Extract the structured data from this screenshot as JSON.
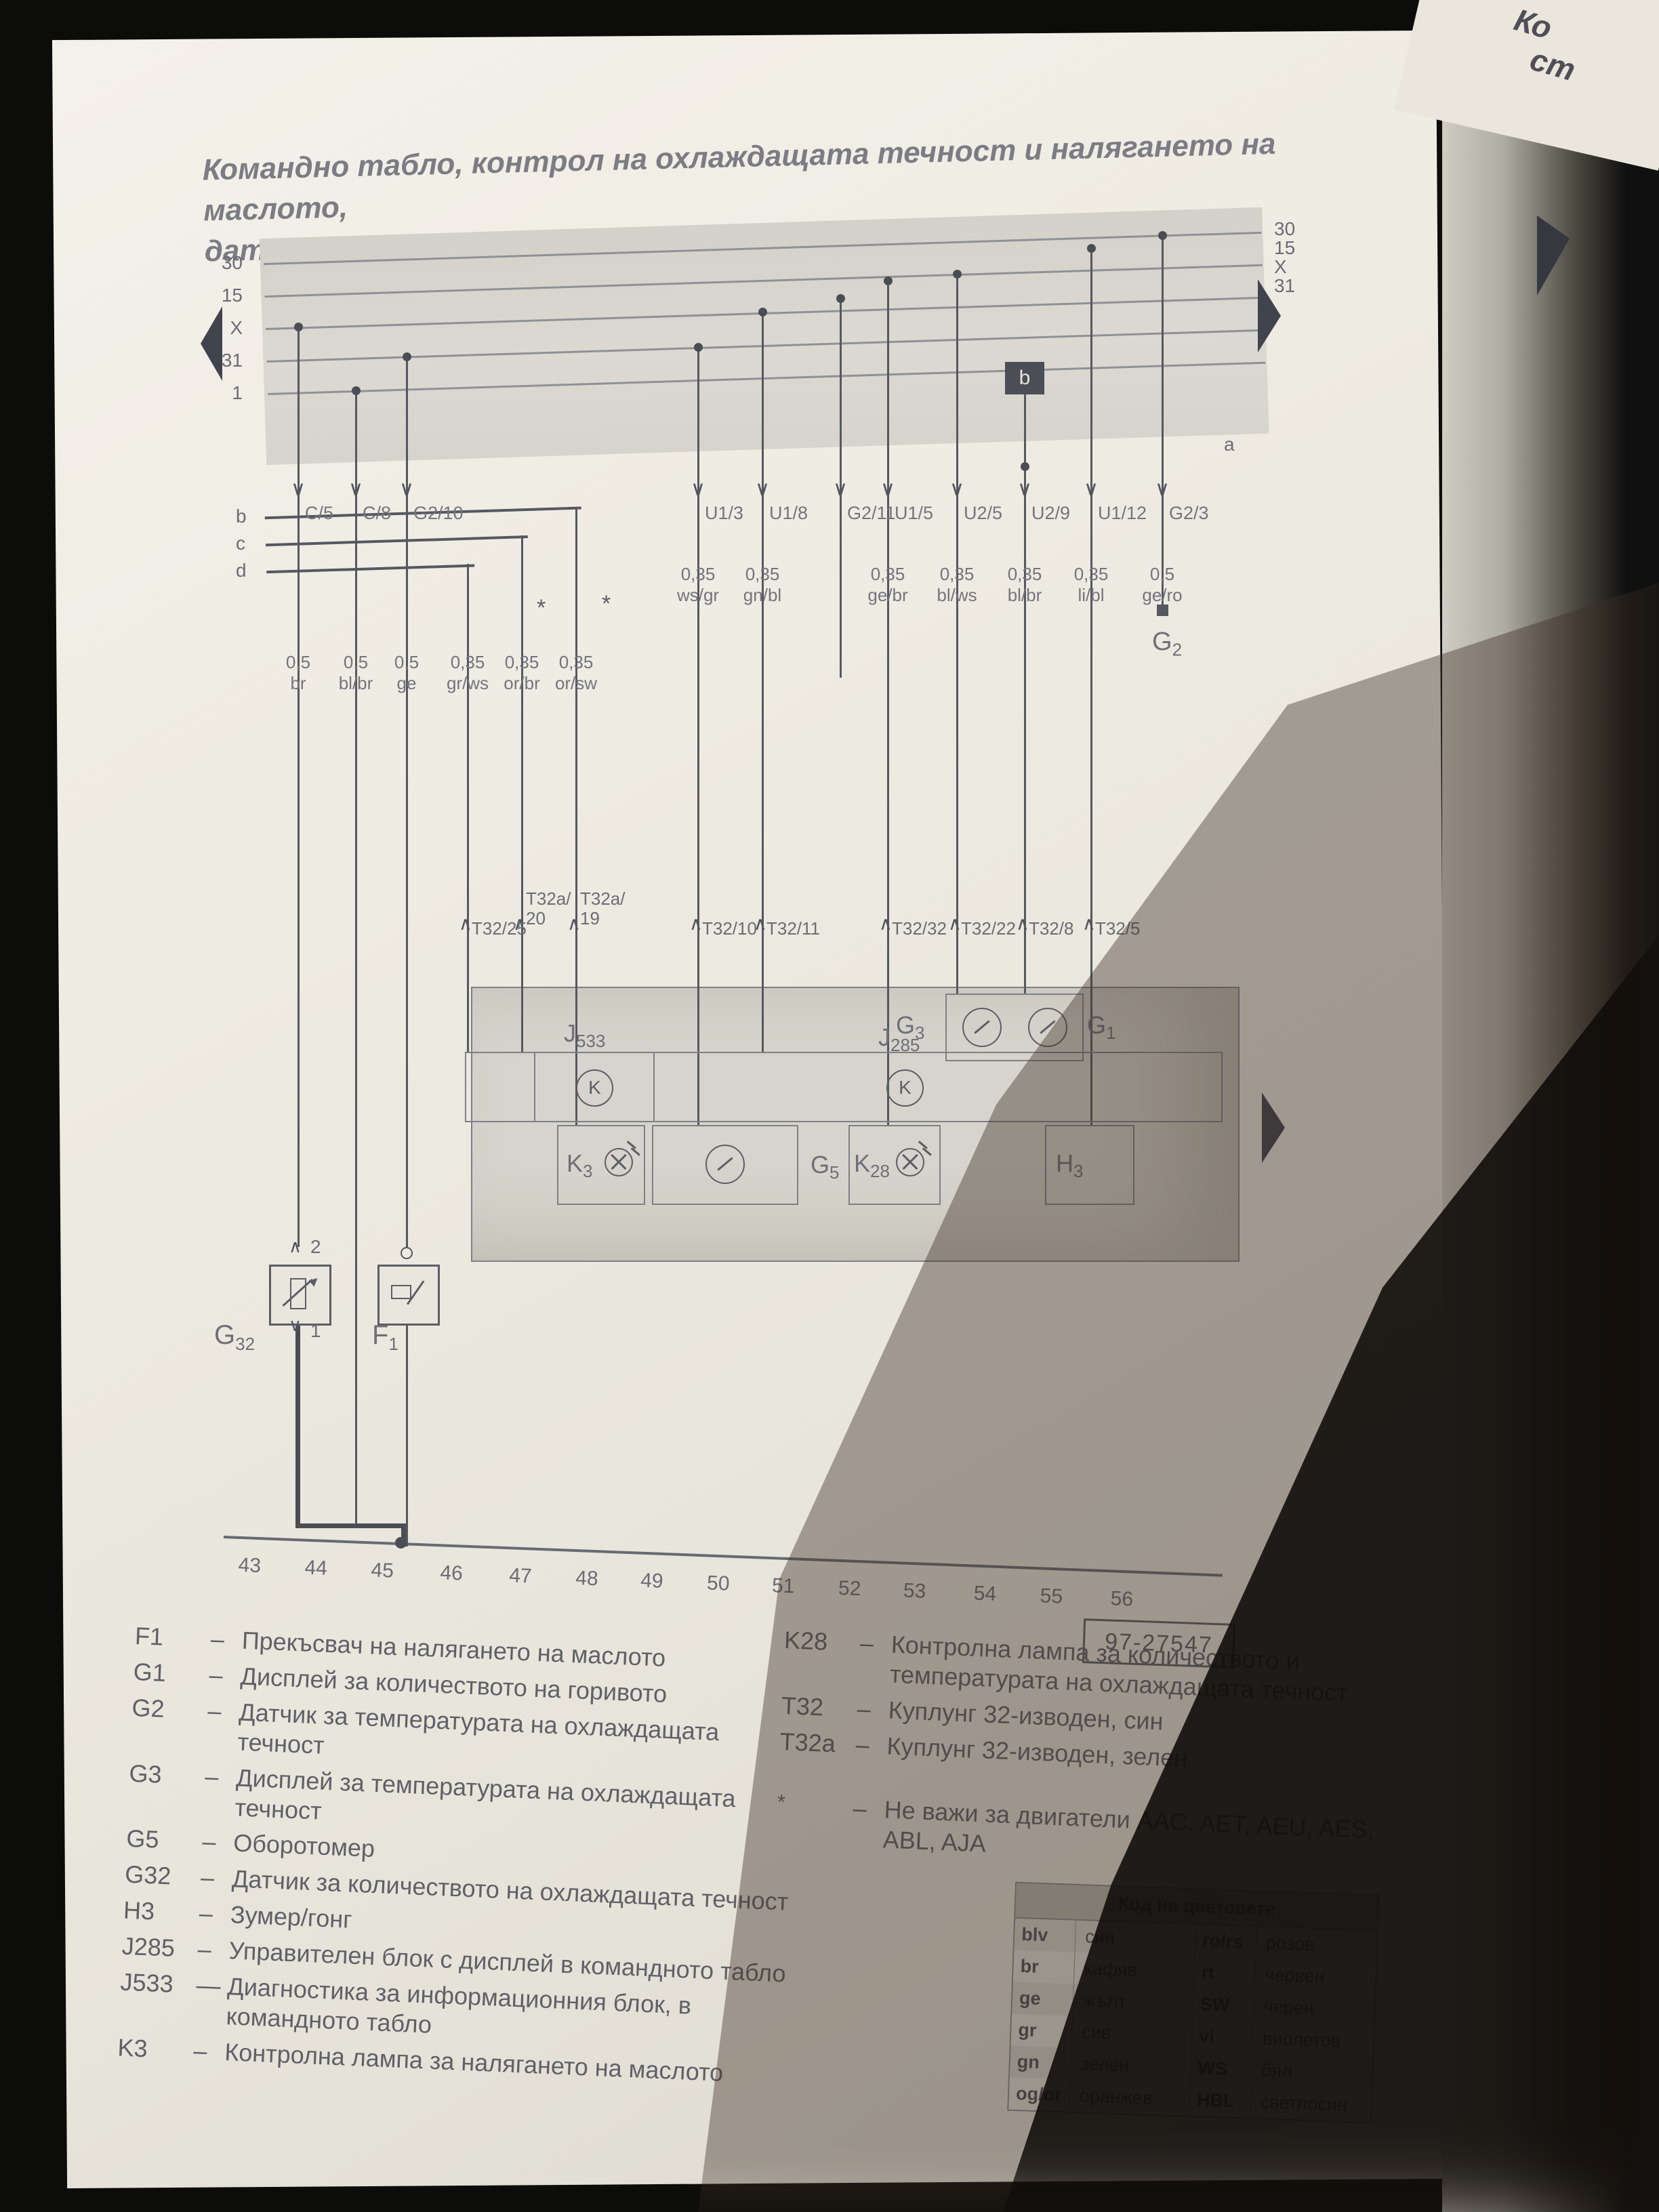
{
  "title": {
    "line1": "Командно табло, контрол на охлаждащата течност и налягането на маслото,",
    "line2": "датчик за количеството на горивото, оборотомер"
  },
  "corner": {
    "line1": "Ко",
    "line2": "ст"
  },
  "bus": {
    "left_terminals": [
      "30",
      "15",
      "X",
      "31",
      "1"
    ],
    "right_terminals": [
      "30",
      "15",
      "X",
      "31"
    ],
    "a_label": "a",
    "b_box": "b",
    "row_labels": [
      "b",
      "c",
      "d"
    ]
  },
  "connectors": {
    "labels": [
      "C/5",
      "C/8",
      "G2/10",
      "U1/3",
      "U1/8",
      "G2/11",
      "U1/5",
      "U2/5",
      "U2/9",
      "U1/12",
      "G2/3"
    ]
  },
  "wire_labels": {
    "left": [
      {
        "size": "0,5",
        "color": "br"
      },
      {
        "size": "0,5",
        "color": "bl/br"
      },
      {
        "size": "0,5",
        "color": "ge"
      },
      {
        "size": "0,35",
        "color": "gr/ws"
      },
      {
        "size": "0,35",
        "color": "or/br"
      },
      {
        "size": "0,35",
        "color": "or/sw"
      }
    ],
    "right": [
      {
        "size": "0,35",
        "color": "ws/gr"
      },
      {
        "size": "0,35",
        "color": "gn/bl"
      },
      {
        "size": "0,35",
        "color": "ge/br"
      },
      {
        "size": "0,35",
        "color": "bl/ws"
      },
      {
        "size": "0,35",
        "color": "bl/br"
      },
      {
        "size": "0,35",
        "color": "li/bl"
      },
      {
        "size": "0,5",
        "color": "ge/ro"
      }
    ],
    "footnote_symbol": "*"
  },
  "t32_terminals": [
    "T32/25",
    "T32a/20",
    "T32a/19",
    "T32/10",
    "T32/11",
    "T32/32",
    "T32/22",
    "T32/8",
    "T32/5"
  ],
  "components": {
    "g2": "G2",
    "g3": "G3",
    "g1": "G1",
    "j533": "J533",
    "j285": "J285",
    "k_symbol": "K",
    "k3": "K3",
    "g5": "G5",
    "k28": "K28",
    "h3": "H3",
    "g32": "G32",
    "f1": "F1",
    "g32_top": "2",
    "g32_bottom": "1"
  },
  "tracks": [
    "43",
    "44",
    "45",
    "46",
    "47",
    "48",
    "49",
    "50",
    "51",
    "52",
    "53",
    "54",
    "55",
    "56"
  ],
  "ref_number": "97-27547",
  "legend_left": [
    {
      "code": "F1",
      "dash": "–",
      "text": "Прекъсвач на налягането на маслото"
    },
    {
      "code": "G1",
      "dash": "–",
      "text": "Дисплей за количеството на горивото"
    },
    {
      "code": "G2",
      "dash": "–",
      "text": "Датчик за температурата на охлаждащата течност"
    },
    {
      "code": "G3",
      "dash": "–",
      "text": "Дисплей за температурата на охлаждащата течност"
    },
    {
      "code": "G5",
      "dash": "–",
      "text": "Оборотомер"
    },
    {
      "code": "G32",
      "dash": "–",
      "text": "Датчик за количеството на охлаждащата течност"
    },
    {
      "code": "H3",
      "dash": "–",
      "text": "Зумер/гонг"
    },
    {
      "code": "J285",
      "dash": "–",
      "text": "Управителен блок с дисплей в командното табло"
    },
    {
      "code": "J533",
      "dash": "—",
      "text": "Диагностика за информационния блок, в командното табло"
    },
    {
      "code": "K3",
      "dash": "–",
      "text": "Контролна лампа за налягането на маслото"
    }
  ],
  "legend_right": [
    {
      "code": "K28",
      "dash": "–",
      "text": "Контролна лампа за количеството и температурата на охлаждащата течност"
    },
    {
      "code": "T32",
      "dash": "–",
      "text": "Куплунг 32-изводен, син"
    },
    {
      "code": "T32a",
      "dash": "–",
      "text": "Куплунг 32-изводен, зелен"
    }
  ],
  "note": {
    "symbol": "*",
    "dash": "–",
    "text": "Не важи за двигатели AAC, AET, AEU, AES, ABL, AJA"
  },
  "color_table": {
    "title": "Код на цветовете",
    "rows": [
      {
        "c1": "blv",
        "n1": "син",
        "c2": "ro/rs",
        "n2": "розов"
      },
      {
        "c1": "br",
        "n1": "кафяв",
        "c2": "rt",
        "n2": "червен"
      },
      {
        "c1": "ge",
        "n1": "жълт",
        "c2": "SW",
        "n2": "черен"
      },
      {
        "c1": "gr",
        "n1": "сив",
        "c2": "vi",
        "n2": "виолетов"
      },
      {
        "c1": "gn",
        "n1": "зелен",
        "c2": "WS",
        "n2": "бял"
      },
      {
        "c1": "og/or",
        "n1": "оранжев",
        "c2": "HBL",
        "n2": "светлосин"
      }
    ]
  }
}
